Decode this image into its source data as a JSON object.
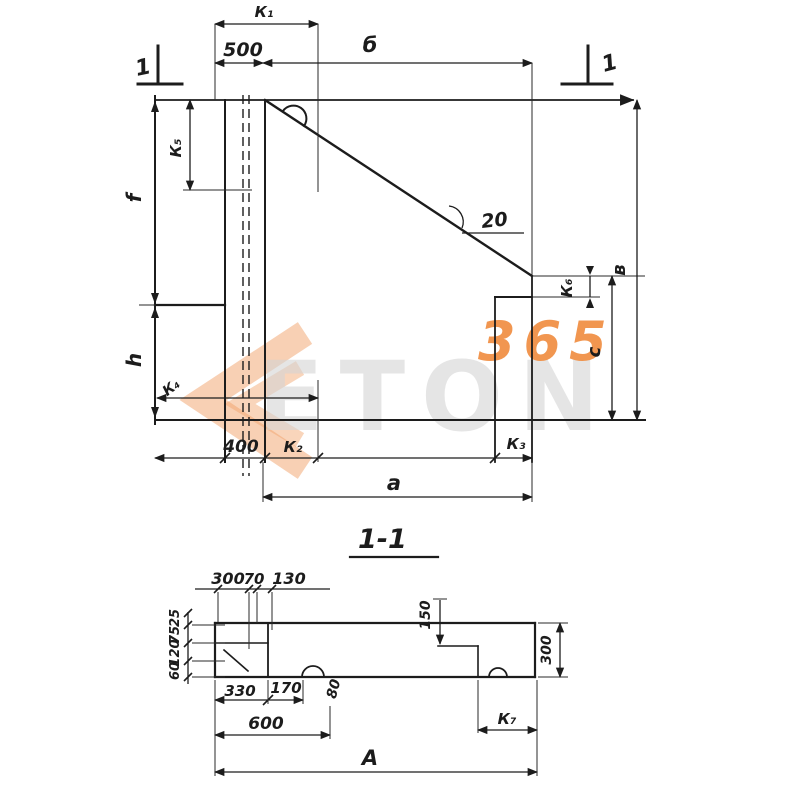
{
  "upper": {
    "marker_left": "1",
    "marker_right": "1",
    "k1": "К₁",
    "d500": "500",
    "b": "б",
    "k5": "К₅",
    "f": "f",
    "h": "h",
    "k4": "К₄",
    "d400": "400",
    "k2": "К₂",
    "k3": "К₃",
    "a": "а",
    "k6": "К₆",
    "c": "с",
    "v": "в",
    "slope": "20"
  },
  "section": {
    "title": "1-1",
    "t300": "300",
    "t70": "70",
    "t130": "130",
    "l25": "25",
    "l75": "75",
    "l120": "120",
    "l60": "60",
    "d150": "150",
    "d330": "330",
    "d170": "170",
    "d600": "600",
    "d80": "80",
    "k7": "К₇",
    "A": "А",
    "r300": "300"
  },
  "watermark": {
    "letters": "ETON",
    "number": "365"
  },
  "colors": {
    "ink": "#1c1c1c",
    "accent": "#ef8b3d",
    "letters_gray": "#d4d4d4"
  }
}
